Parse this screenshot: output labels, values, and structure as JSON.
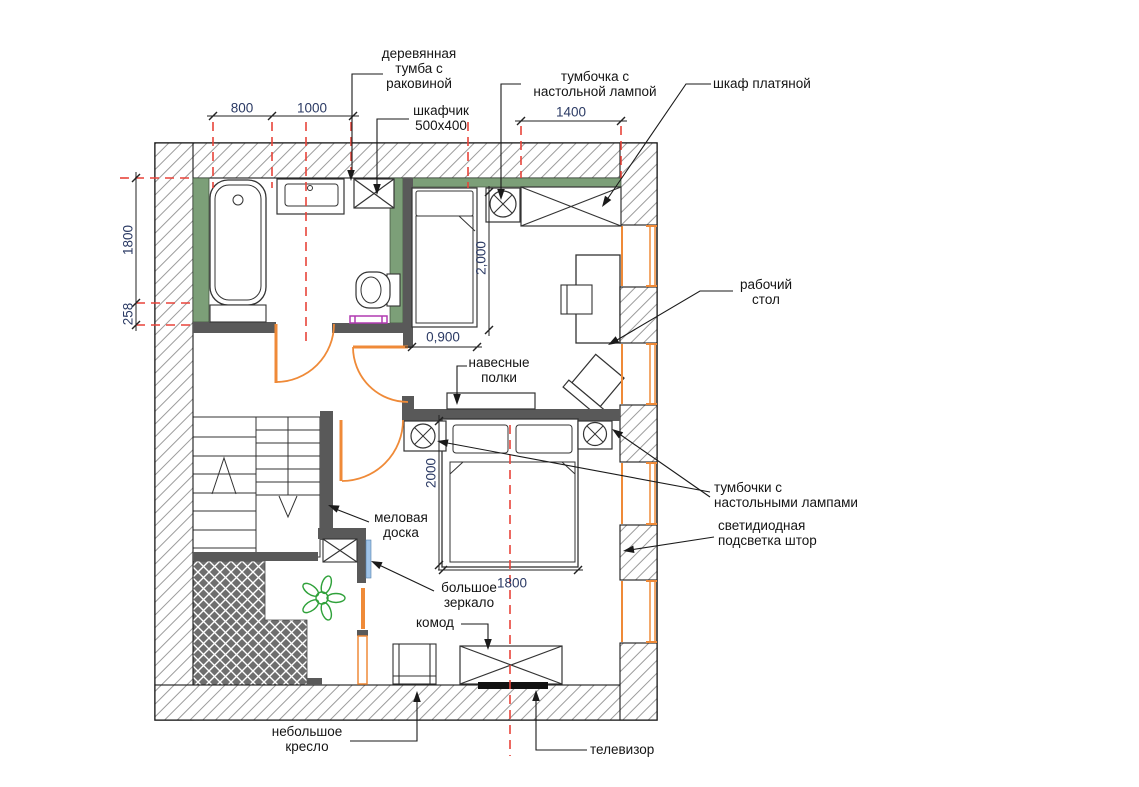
{
  "plan": {
    "labels": {
      "vanity": "деревянная\nтумба с\nраковиной",
      "cabinet": "шкафчик\n500х400",
      "nightstand_top": "тумбочка с\nнастольной лампой",
      "wardrobe": "шкаф платяной",
      "desk": "рабочий\nстол",
      "shelves": "навесные\nполки",
      "nightstands": "тумбочки с\nнастольными лампами",
      "led_curtain": "светидиодная\nподсветка штор",
      "chalkboard": "меловая\nдоска",
      "mirror": "большое\nзеркало",
      "dresser": "комод",
      "armchair": "небольшое\nкресло",
      "tv": "телевизор"
    },
    "dimensions": {
      "top_left": "800",
      "top_mid": "1000",
      "top_right": "1400",
      "left_upper": "1800",
      "left_lower": "258",
      "bed1_length": "2,000",
      "bed1_width": "0,900",
      "bed2_length": "2000",
      "bed2_width": "1800"
    },
    "colors": {
      "wall_hatch_line": "#9b9b9b",
      "interior_wall": "#595959",
      "green_finish": "#7c9f78",
      "joinery_orange": "#ef8a38",
      "centerline_red": "#e8443a",
      "mirror_blue": "#9fc3e8",
      "towel_magenta": "#b13ab1",
      "plant_green": "#2fa13a",
      "dimension_text": "#2b3a64",
      "tv_black": "#111111"
    }
  }
}
